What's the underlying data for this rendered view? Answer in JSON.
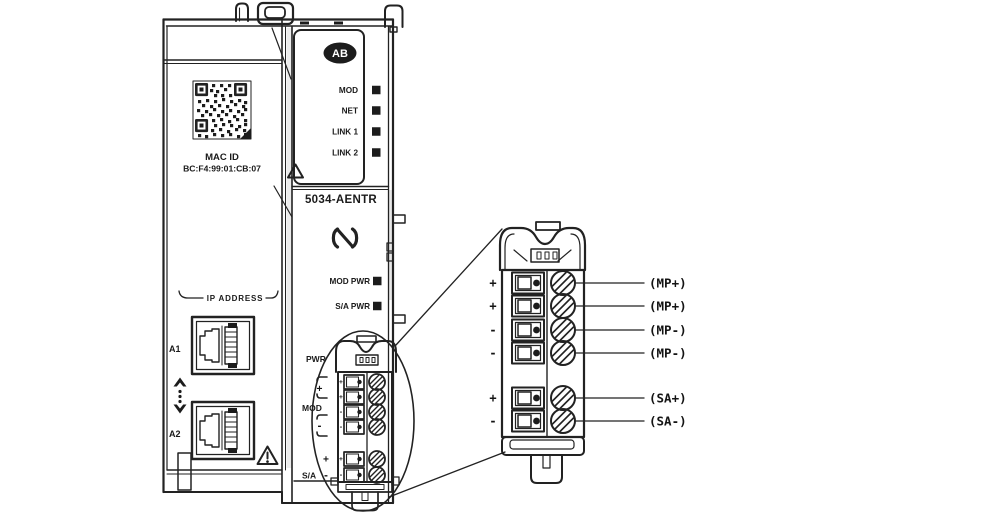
{
  "module": {
    "brand": "AB",
    "model": "5034-AENTR",
    "mac": {
      "label": "MAC ID",
      "value": "BC:F4:99:01:CB:07"
    },
    "status_leds": [
      "MOD",
      "NET",
      "LINK 1",
      "LINK 2"
    ],
    "power_leds": [
      "MOD PWR",
      "S/A PWR"
    ],
    "ip_section": {
      "label": "IP ADDRESS",
      "ports": [
        "A1",
        "A2"
      ]
    },
    "power_terminal": {
      "pwr_label": "PWR",
      "groups": [
        {
          "label": "MOD",
          "plus": "+",
          "minus": "-"
        },
        {
          "label": "S/A",
          "plus": "+",
          "minus": "-"
        }
      ],
      "terminal_signs": [
        "+",
        "+",
        "-",
        "-",
        "+",
        "-"
      ]
    }
  },
  "detail": {
    "terminal_signs": [
      "+",
      "+",
      "-",
      "-",
      "+",
      "-"
    ],
    "wire_labels": [
      "(MP+)",
      "(MP+)",
      "(MP-)",
      "(MP-)",
      "(SA+)",
      "(SA-)"
    ]
  },
  "colors": {
    "line": "#222222",
    "text": "#1a1a1a",
    "background": "#ffffff"
  }
}
